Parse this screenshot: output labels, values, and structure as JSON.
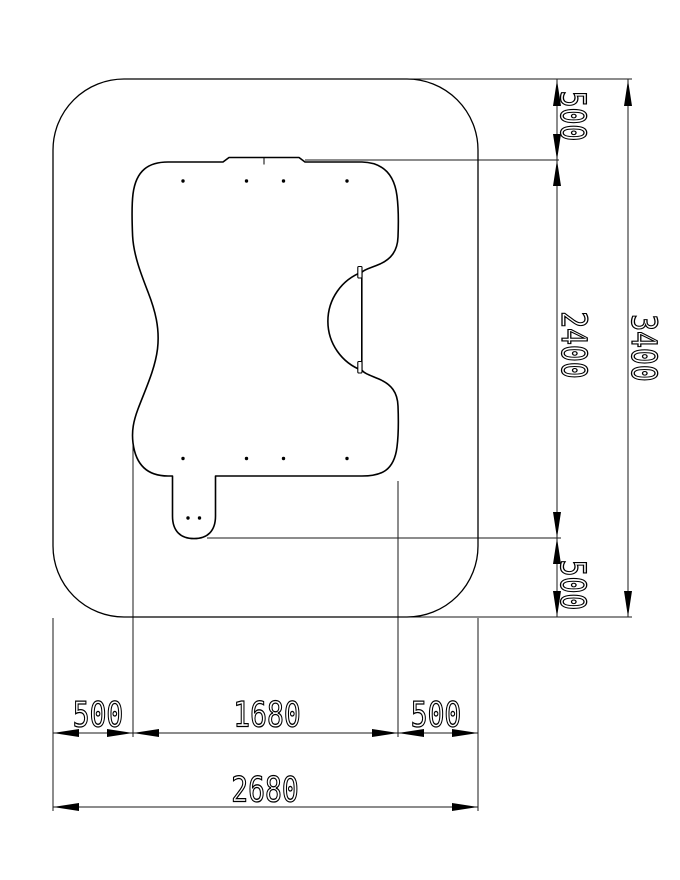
{
  "colors": {
    "background": "#ffffff",
    "part_line": "#000000",
    "dim_line": "#1a1a1a"
  },
  "dimensions": {
    "v_top_offset": "500",
    "v_inner_height": "2400",
    "v_total_height": "3400",
    "v_bottom_offset": "500",
    "h_left_offset": "500",
    "h_inner_width": "1680",
    "h_right_offset": "500",
    "h_total_width": "2680"
  }
}
